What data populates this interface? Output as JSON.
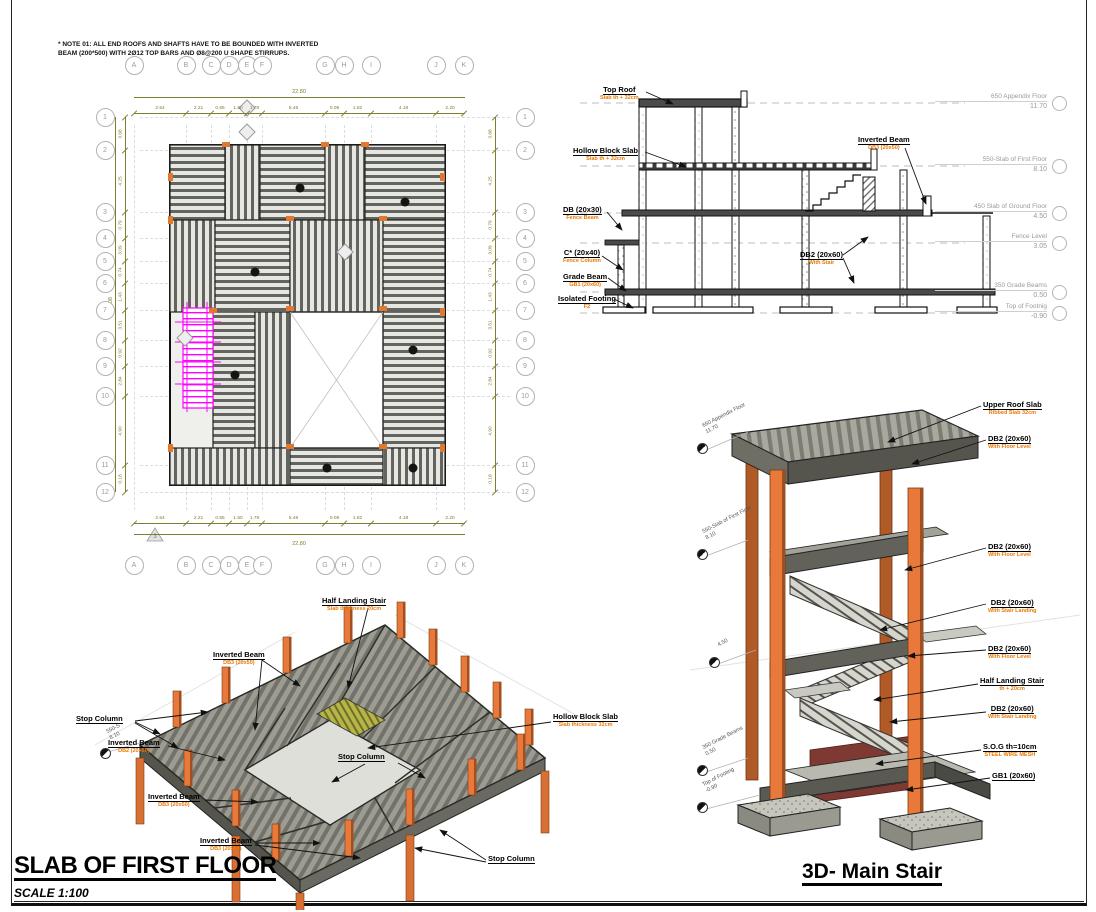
{
  "note": {
    "line1": "* NOTE 01: ALL END ROOFS AND SHAFTS HAVE TO BE BOUNDED WITH INVERTED",
    "line2": "BEAM (200*500) WITH 2Ø12 TOP BARS AND Ø8@200 U SHAPE STIRRUPS."
  },
  "plan": {
    "grid_cols": [
      "A",
      "B",
      "C",
      "D",
      "E",
      "F",
      "G",
      "H",
      "I",
      "J",
      "K"
    ],
    "grid_rows": [
      "1",
      "2",
      "3",
      "4",
      "5",
      "6",
      "7",
      "8",
      "9",
      "10",
      "11",
      "12"
    ],
    "dims_top": [
      "2.54",
      "2.21",
      "0.65",
      "1.50",
      "1.78",
      "5.48",
      "0.09",
      "1.82",
      "4.18",
      "2.20"
    ],
    "total_width": "22.80",
    "dims_left": [
      "3.68",
      "4.25",
      "0.79",
      "3.09",
      "0.74",
      "1.43",
      "3.51",
      "0.92",
      "2.84",
      "4.90",
      "0.18"
    ],
    "total_height": "23.08",
    "marker_label": "3"
  },
  "section": {
    "labels": [
      {
        "title": "Top Roof",
        "sub": "Slab th + 32cm"
      },
      {
        "title": "Hollow Block Slab",
        "sub": "Slab th + 32cm"
      },
      {
        "title": "DB (20x30)",
        "sub": "Fence Beam"
      },
      {
        "title": "C* (20x40)",
        "sub": "Fence Column"
      },
      {
        "title": "Grade Beam",
        "sub": "GB1 (20x60)"
      },
      {
        "title": "Isolated Footing",
        "sub": "F2"
      },
      {
        "title": "Inverted Beam",
        "sub": "DB3 (20x50)"
      },
      {
        "title": "DB2 (20x60)",
        "sub": "With Stair"
      }
    ],
    "levels": [
      {
        "name": "650 Appendix Floor",
        "elev": "11.70"
      },
      {
        "name": "550-Slab of First Floor",
        "elev": "8.10"
      },
      {
        "name": "450 Slab of Ground Floor",
        "elev": "4.50"
      },
      {
        "name": "Fence Level",
        "elev": "3.05"
      },
      {
        "name": "350 Grade Beams",
        "elev": "0.50"
      },
      {
        "name": "Top of Footnig",
        "elev": "-0.90"
      }
    ]
  },
  "slab3d": {
    "title": "SLAB OF FIRST FLOOR",
    "scale": "SCALE 1:100",
    "labels": [
      {
        "title": "Half Landing Stair",
        "sub": "Slab thickness 20cm"
      },
      {
        "title": "Inverted Beam",
        "sub": "DB3 (20x50)"
      },
      {
        "title": "Hollow Block Slab",
        "sub": "Slab thickness 32cm"
      },
      {
        "title": "Stop Column",
        "sub": ""
      },
      {
        "title": "Inverted Beam",
        "sub": "DB2 (20x60)"
      },
      {
        "title": "Stop Column",
        "sub": ""
      },
      {
        "title": "Inverted Beam",
        "sub": "DB3 (20x50)"
      },
      {
        "title": "Inverted Beam",
        "sub": "DB3 (20x50)"
      },
      {
        "title": "Stop Column",
        "sub": ""
      }
    ],
    "level_marker": {
      "name": "550-S",
      "elev": "8.10"
    }
  },
  "stair3d": {
    "title": "3D- Main Stair",
    "labels": [
      {
        "title": "Upper Roof Slab",
        "sub": "Ribbed Slab 32cm"
      },
      {
        "title": "DB2 (20x60)",
        "sub": "With Floor Level"
      },
      {
        "title": "DB2 (20x60)",
        "sub": "With Floor Level"
      },
      {
        "title": "DB2 (20x60)",
        "sub": "With Stair Landing"
      },
      {
        "title": "DB2 (20x60)",
        "sub": "With Floor Level"
      },
      {
        "title": "Half Landing Stair",
        "sub": "th + 20cm"
      },
      {
        "title": "DB2 (20x60)",
        "sub": "With Stair Landing"
      },
      {
        "title": "S.O.G th=10cm",
        "sub": "STEEL WIRE MESH"
      },
      {
        "title": "GB1 (20x60)",
        "sub": ""
      }
    ],
    "levels": [
      {
        "name": "650 Appendix Floor",
        "elev": "11.70"
      },
      {
        "name": "550-Slab of First Floor",
        "elev": "8.10"
      },
      {
        "name": "",
        "elev": "4.50"
      },
      {
        "name": "350 Grade Beams",
        "elev": "0.50"
      },
      {
        "name": "Top of Footing",
        "elev": "-0.90"
      }
    ]
  },
  "colors": {
    "column_orange": "#E8793B",
    "column_dark": "#A05020",
    "label_orange": "#E87800",
    "dim_olive": "#7E7E2F",
    "stair_magenta": "#FF00FF",
    "slab_gray": "#98988E"
  }
}
